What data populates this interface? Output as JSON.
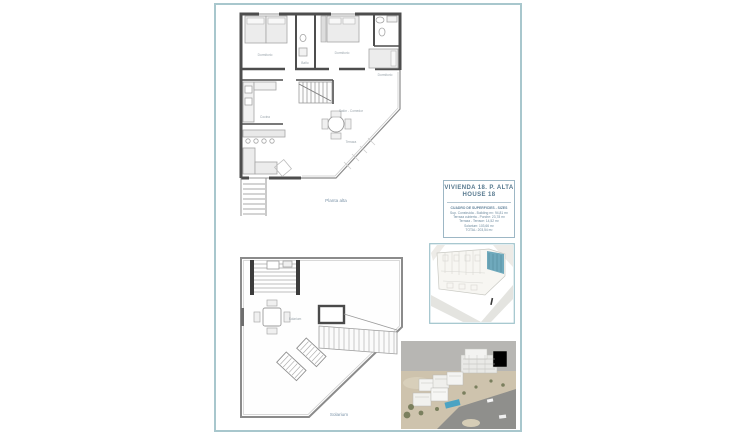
{
  "document": {
    "labels": {
      "upper_plan": "Planta alta",
      "lower_plan": "Solarium"
    },
    "rooms": {
      "bedroom": "Dormitorio",
      "bath": "Baño",
      "kitchen": "Cocina",
      "living": "Salón - Comedor",
      "terrace": "Terraza",
      "solarium_small": "Solarium"
    },
    "title_block": {
      "line1": "VIVIENDA 18. P. ALTA",
      "line2": "HOUSE 18",
      "header": "CUADRO DE SUPERFICIES - SIZES",
      "rows": [
        "Sup. Construida - Building m²: 94,81 m²",
        "Terraza cubierta - Porche: 23,78 m²",
        "Terraza - Terrace: 14,52 m²",
        "Solarium: 103,66 m²",
        "TOTAL: 203,54 m²"
      ]
    },
    "colors": {
      "frame": "#a8c7cd",
      "accent": "#56788e",
      "wall": "#4d4d4d",
      "map_highlight": "#6fa9bc",
      "pool": "#4ba3c3",
      "sky": "#b7b6b3",
      "ground": "#cec3ad"
    }
  }
}
